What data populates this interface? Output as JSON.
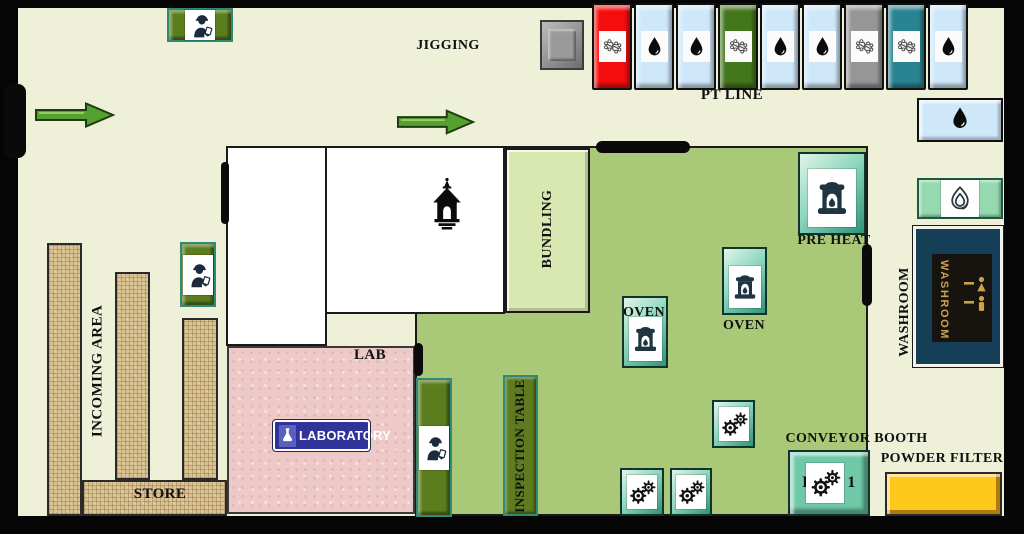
{
  "labels": {
    "jigging": "JIGGING",
    "pt_line": "PT LINE",
    "bundling": "BUNDLING",
    "pre_heat": "PRE HEAT",
    "oven_mid": "OVEN",
    "oven_right": "OVEN",
    "washroom_label": "WASHROOM",
    "washroom_sign": "WASHROOM",
    "incoming_area": "INCOMING AREA",
    "store": "STORE",
    "lab": "LAB",
    "laboratory_sign": "LABORATORY",
    "inspection_table": "INSPECTION TABLE",
    "conveyor_booth": "CONVEYOR BOOTH",
    "powder_filter": "POWDER FILTER",
    "booth_prefix": "P",
    "booth_number": "1"
  },
  "pt_line_tanks": [
    {
      "color": "#f50d0d",
      "icon": "molecule"
    },
    {
      "color": "#cfe8f9",
      "icon": "droplet"
    },
    {
      "color": "#cfe8f9",
      "icon": "droplet"
    },
    {
      "color": "#44761c",
      "icon": "molecule"
    },
    {
      "color": "#cfe8f9",
      "icon": "droplet"
    },
    {
      "color": "#cfe8f9",
      "icon": "droplet"
    },
    {
      "color": "#969696",
      "icon": "molecule"
    },
    {
      "color": "#2a8391",
      "icon": "molecule"
    },
    {
      "color": "#cfe8f9",
      "icon": "droplet"
    }
  ],
  "icons": [
    "worker-icon",
    "furnace-icon",
    "gears-icon",
    "droplet-icon",
    "molecule-icon",
    "flame-icon",
    "tower-icon",
    "restroom-icon",
    "flask-icon",
    "arrow-right-icon",
    "door-marker",
    "machine-square"
  ],
  "colors": {
    "wall": "#050505",
    "floor": "#eef0d8",
    "production_floor": "#a9c878",
    "bundling_area": "#d9e8b0",
    "lab_area": "#edc9c7",
    "storage_burlap": "#d9c08f",
    "olive_station": "#5c7d1e",
    "equipment_mint": "#8fd7bd",
    "booth_aqua": "#6fc9a8",
    "tank_red": "#f50d0d",
    "tank_blue": "#cfe8f9",
    "tank_green": "#44761c",
    "tank_gray": "#969696",
    "tank_teal": "#2a8391",
    "powder_filter_yellow": "#fec71c",
    "arrow_green": "#55a02e",
    "washroom_sign_bg": "#153f56",
    "washroom_sign_gold": "#c9a24b",
    "laboratory_sign_bg": "#31339b"
  }
}
